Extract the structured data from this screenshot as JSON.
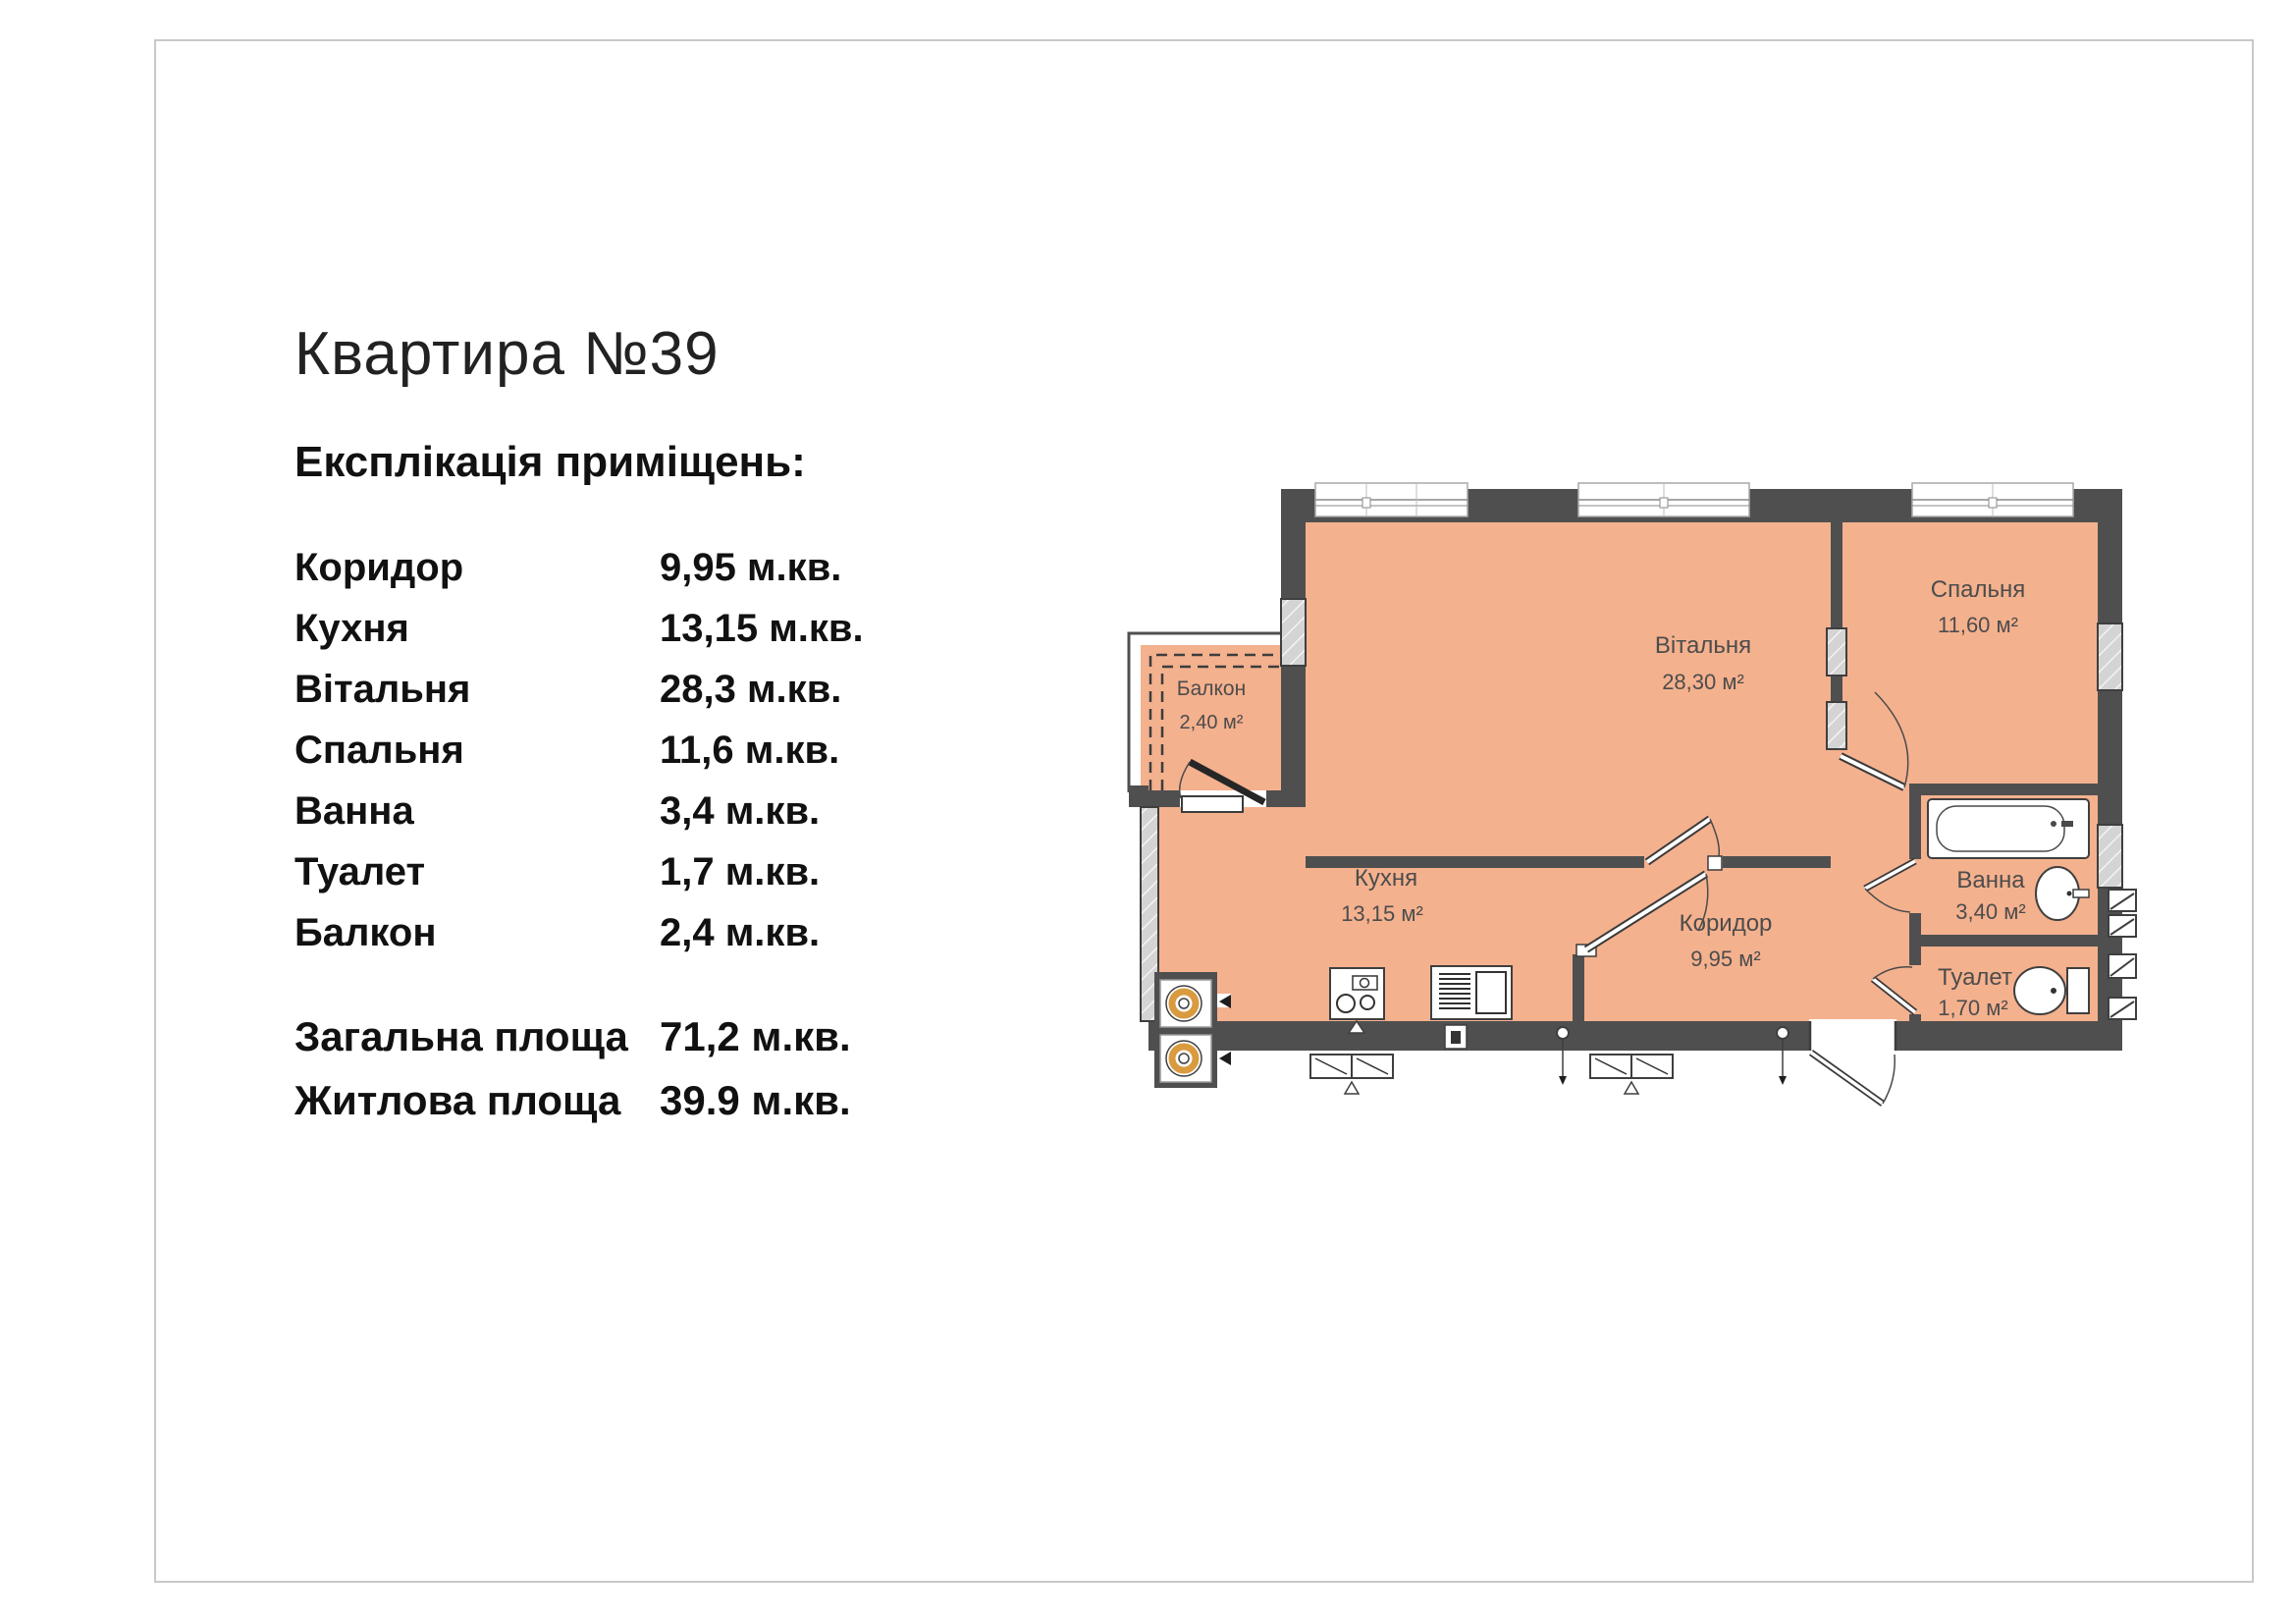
{
  "page": {
    "background": "#ffffff",
    "frame_border_color": "#c9c9c9"
  },
  "header": {
    "title": "Квартира №39",
    "subtitle": "Експлікація приміщень:"
  },
  "rooms": [
    {
      "name": "Коридор",
      "area": "9,95 м.кв."
    },
    {
      "name": "Кухня",
      "area": "13,15 м.кв."
    },
    {
      "name": "Вітальня",
      "area": "28,3 м.кв."
    },
    {
      "name": "Спальня",
      "area": "11,6 м.кв."
    },
    {
      "name": "Ванна",
      "area": "3,4 м.кв."
    },
    {
      "name": "Туалет",
      "area": "1,7 м.кв."
    },
    {
      "name": "Балкон",
      "area": "2,4 м.кв."
    }
  ],
  "totals": [
    {
      "label": "Загальна площа",
      "value": "71,2 м.кв."
    },
    {
      "label": "Житлова площа",
      "value": "39.9 м.кв."
    }
  ],
  "plan": {
    "colors": {
      "floor": "#f4b18e",
      "wall": "#4f4f4f",
      "glazing": "#d4d4d4",
      "fixture_accent": "#d99b3f",
      "label": "#4c4c4c"
    },
    "labels": {
      "living": {
        "name": "Вітальня",
        "area": "28,30 м²"
      },
      "bedroom": {
        "name": "Спальня",
        "area": "11,60 м²"
      },
      "balcony": {
        "name": "Балкон",
        "area": "2,40 м²"
      },
      "kitchen": {
        "name": "Кухня",
        "area": "13,15 м²"
      },
      "corridor": {
        "name": "Коридор",
        "area": "9,95 м²"
      },
      "bath": {
        "name": "Ванна",
        "area": "3,40 м²"
      },
      "toilet": {
        "name": "Туалет",
        "area": "1,70 м²"
      }
    }
  }
}
